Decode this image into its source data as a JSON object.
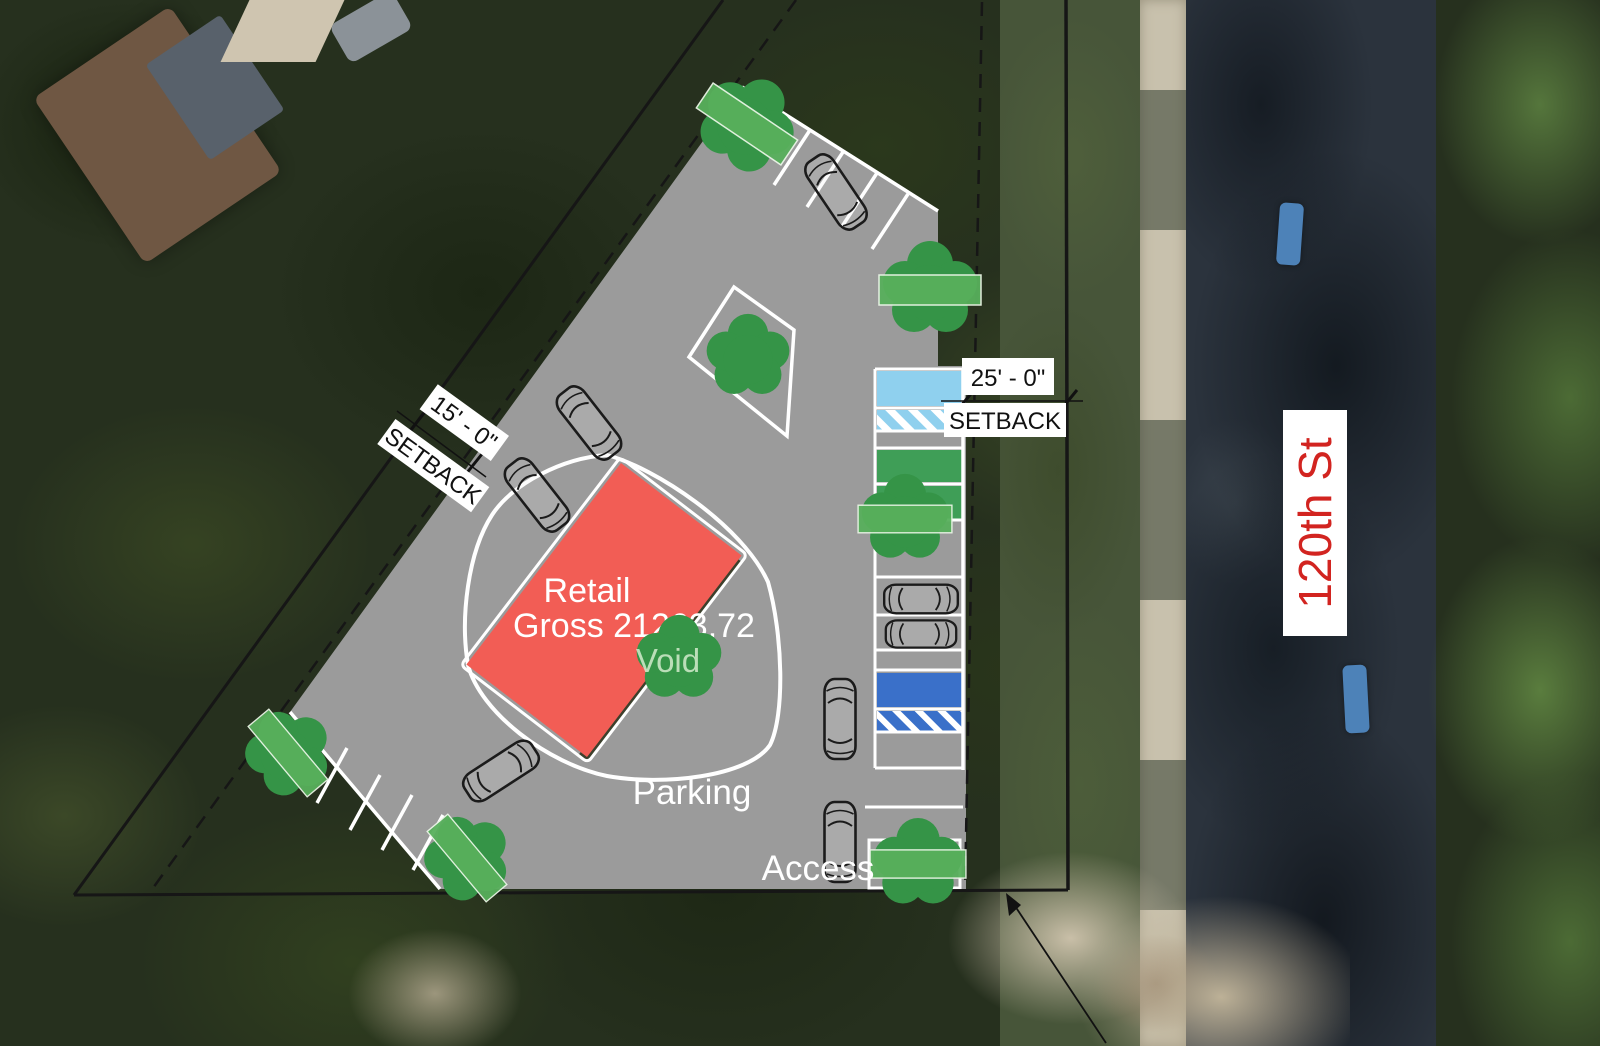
{
  "plan": {
    "building_label": {
      "name": "Retail",
      "area": "Gross 21263.72",
      "void": "Void"
    },
    "area_labels": {
      "parking": "Parking",
      "access": "Access"
    },
    "setback_left": {
      "dimension": "15' - 0\"",
      "label": "SETBACK"
    },
    "setback_right": {
      "dimension": "25' - 0\"",
      "label": "SETBACK"
    },
    "street": {
      "name": "120th St"
    }
  },
  "colors": {
    "pavement": "#9b9b9b",
    "building": "#f25d55",
    "building_shadow": "#3d402c",
    "tree": "#359447",
    "hedge": "#58b05c",
    "stall_lightblue": "#8fd0ee",
    "stall_green": "#3f9e57",
    "stall_accessible_blue": "#3a70c9",
    "stripe_white": "#ffffff",
    "boundary": "#161616",
    "street_text": "#d22420"
  }
}
